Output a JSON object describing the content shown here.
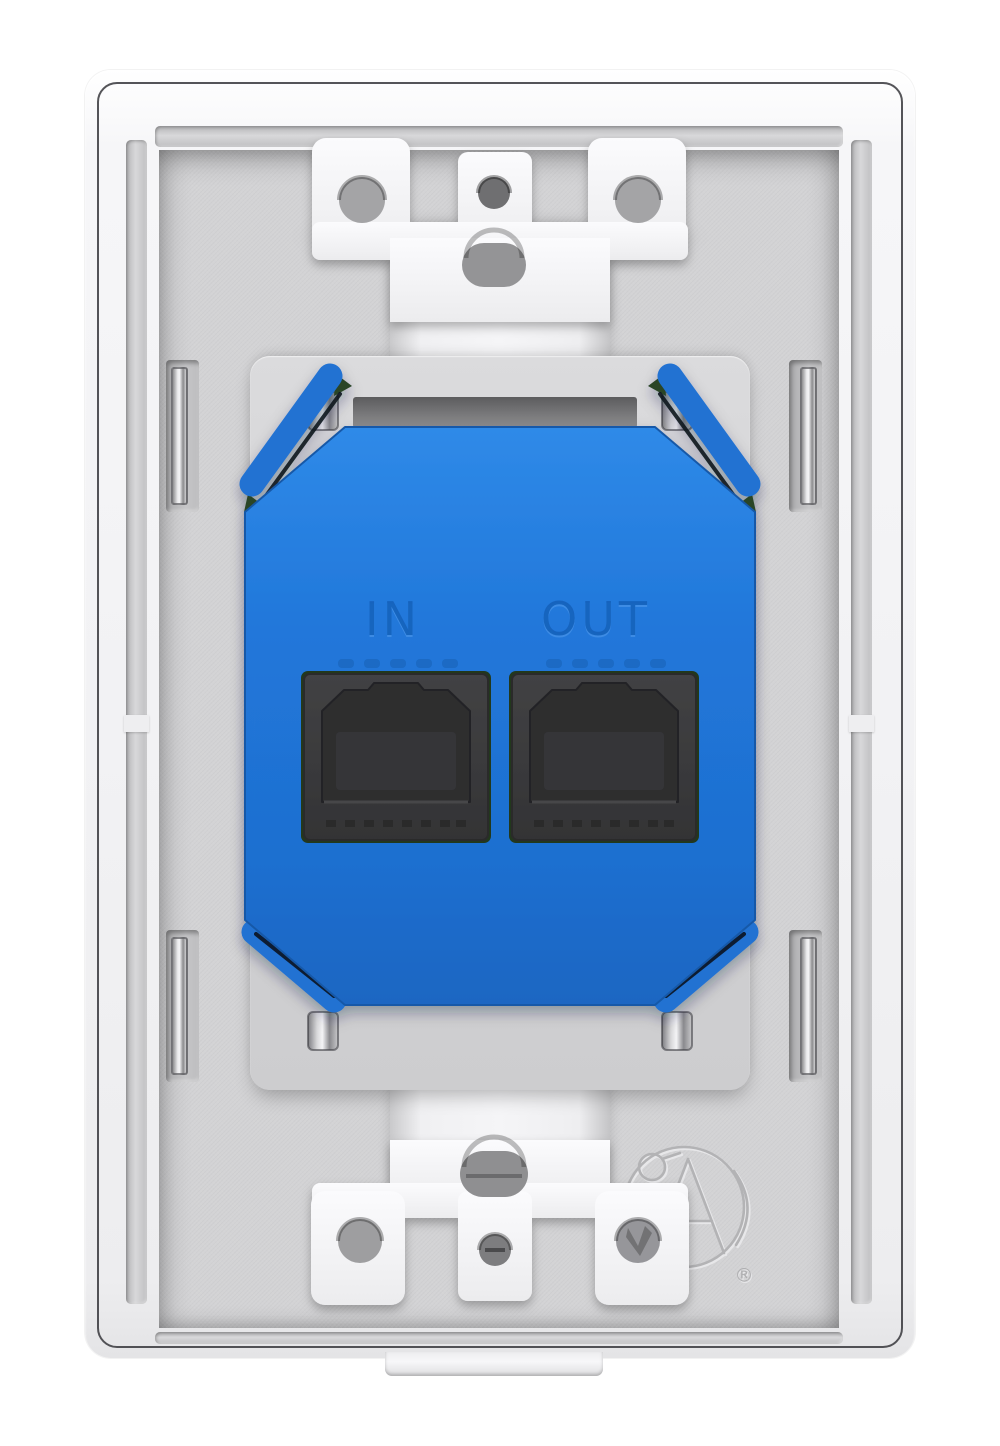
{
  "device": {
    "view_label": "wall plate rear view",
    "module_color_name": "blue"
  },
  "ports": [
    {
      "id": "in",
      "label": "IN"
    },
    {
      "id": "out",
      "label": "OUT"
    }
  ],
  "brand": {
    "logo": "atlas-circle-a-emblem",
    "registered_mark": "®"
  },
  "hardware": {
    "rj45_jack_count": 2,
    "module_spring_clip_count": 4,
    "side_retainer_clip_count": 4,
    "mounting_ear_hole_count": 4,
    "oval_screw_slot_count": 2,
    "center_screw_hole_count": 2
  },
  "colors": {
    "module_blue": "#2077DA",
    "module_blue_dark": "#1659A8",
    "plate_white": "#F5F5F7",
    "recess_gray": "#D3D3D5",
    "jack_dark": "#353537",
    "pcb_green": "#2B4527",
    "metal_silver": "#D9D9DB"
  }
}
